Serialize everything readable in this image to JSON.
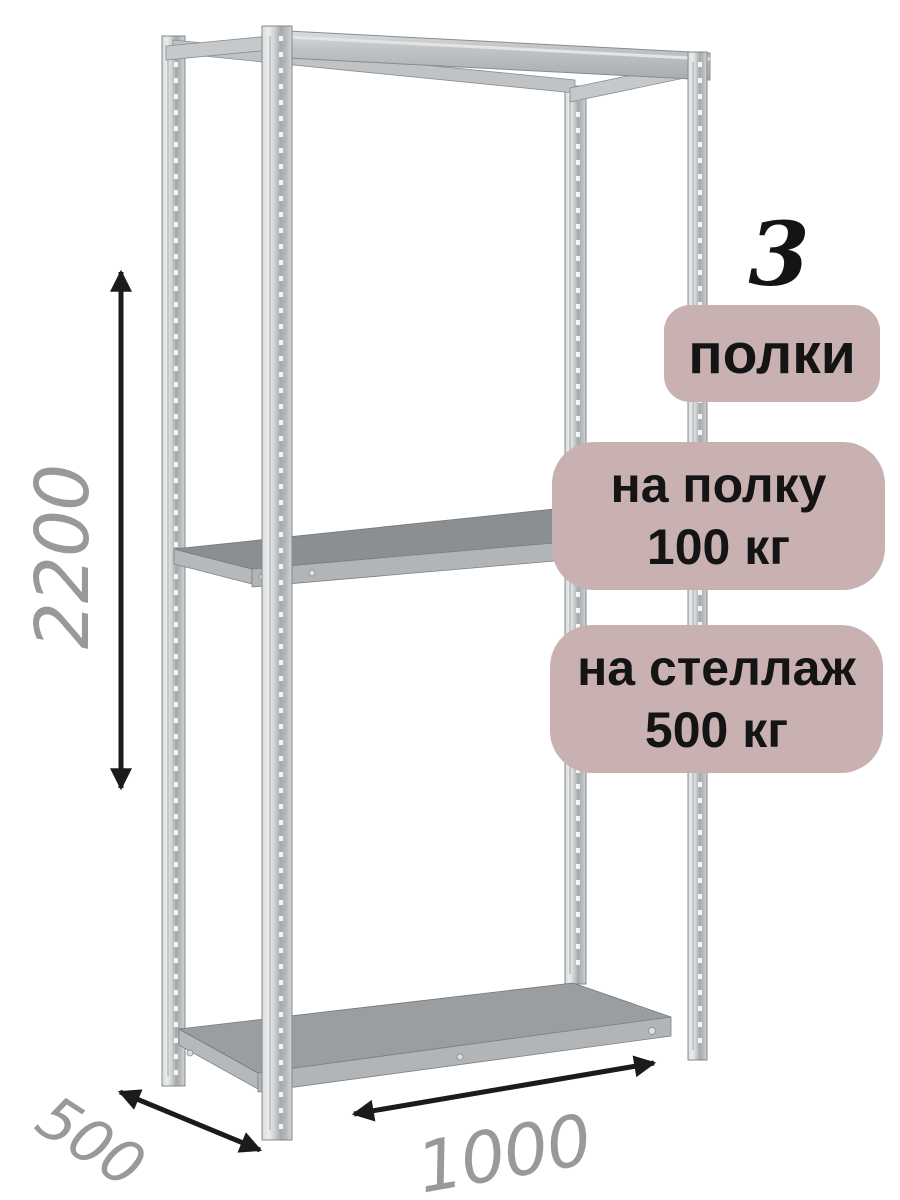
{
  "badges": {
    "count": "3",
    "count_label": "полки",
    "per_shelf_line1": "на полку",
    "per_shelf_line2": "100 кг",
    "per_rack_line1": "на стеллаж",
    "per_rack_line2": "500 кг"
  },
  "dimensions": {
    "height_mm": "2200",
    "depth_mm": "500",
    "width_mm": "1000"
  },
  "colors": {
    "badge-bg": "#cab1b1",
    "badge-text": "#141414",
    "dim-text": "#97999b",
    "arrow": "#1b1b1b",
    "bg": "#ffffff"
  },
  "illustration": {
    "subject": "metal shelving rack with 3 shelves",
    "shelf_count": 3
  }
}
